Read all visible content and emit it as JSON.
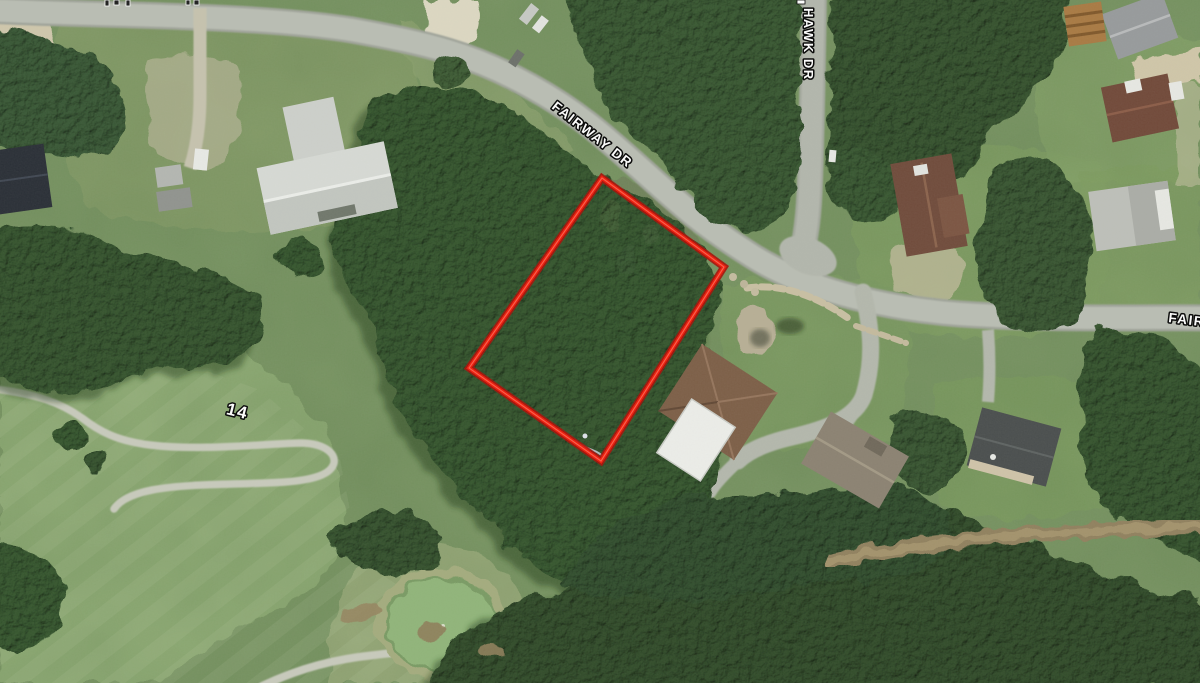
{
  "map": {
    "image_type": "aerial-satellite-photo",
    "street_labels": {
      "fairway_main": "FAIRWAY DR",
      "fairway_right_clipped": "FAIR",
      "hawk": "HAWK DR"
    },
    "golf": {
      "hole_number": "14"
    },
    "parcel": {
      "points": "602,178 724,267 601,461 469,368",
      "outline_color": "#f01505",
      "outline_edge_color": "#a50c04"
    },
    "palette": {
      "forest": "#31502b",
      "lawn": "#7a9663",
      "fairway_grass": "#90ad74",
      "road": "#b6bab0",
      "dirt": "#c9c0a4",
      "label_fill": "#ffffff",
      "label_outline": "#000000"
    }
  }
}
